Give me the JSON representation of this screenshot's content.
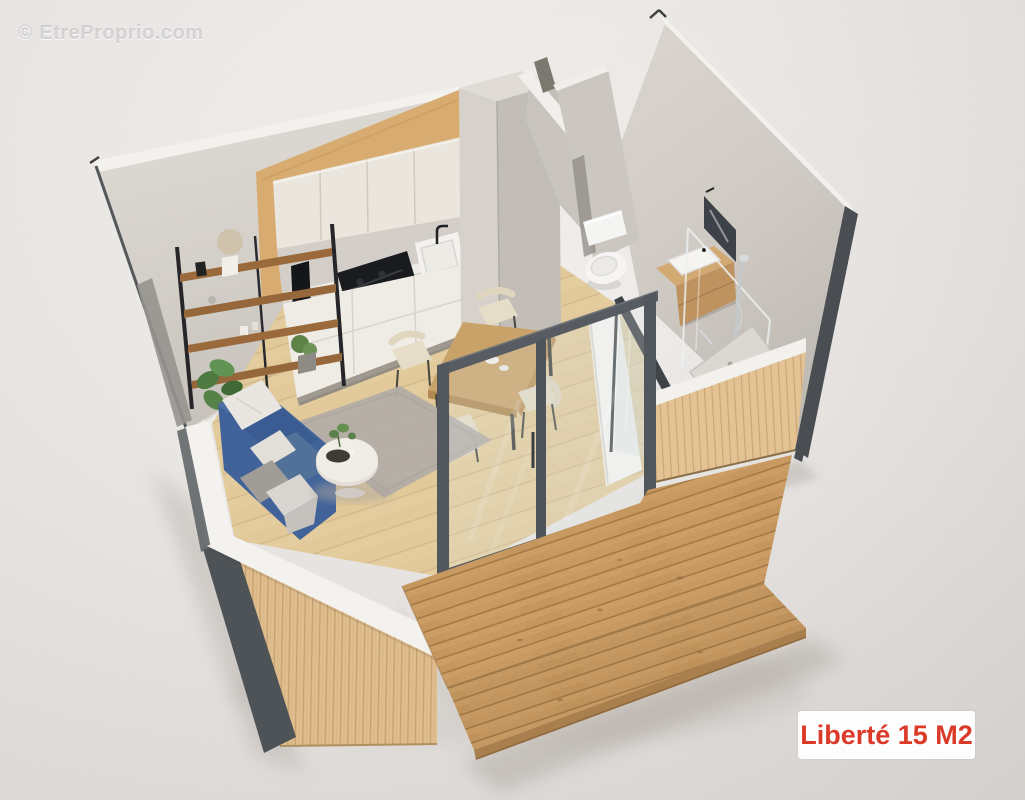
{
  "watermark": {
    "text": "© EtreProprio.com"
  },
  "badge": {
    "label": "Liberté 15 M2"
  },
  "scene": {
    "description": "3D cutaway isometric render of a 15 m2 studio tiny-house floor plan",
    "rooms": [
      "kitchen",
      "living-area",
      "dining-area",
      "bathroom",
      "entry",
      "wood-deck"
    ]
  },
  "palette": {
    "background": "#e7e4e1",
    "concrete_wall": "#d6d2cb",
    "wall_cap_white": "#f4f2ee",
    "wood_cladding": "#dfbd8c",
    "deck_wood": "#c89a62",
    "floor_wood": "#e9d2a3",
    "cabinet_cream": "#eae5dd",
    "cabinet_wood_band": "#d8ac71",
    "sofa_blue": "#45669b",
    "frame_dark": "#51575c",
    "trim_dark": "#4a4e52",
    "badge_text": "#dc3a28",
    "badge_bg": "#fdfdfd"
  }
}
